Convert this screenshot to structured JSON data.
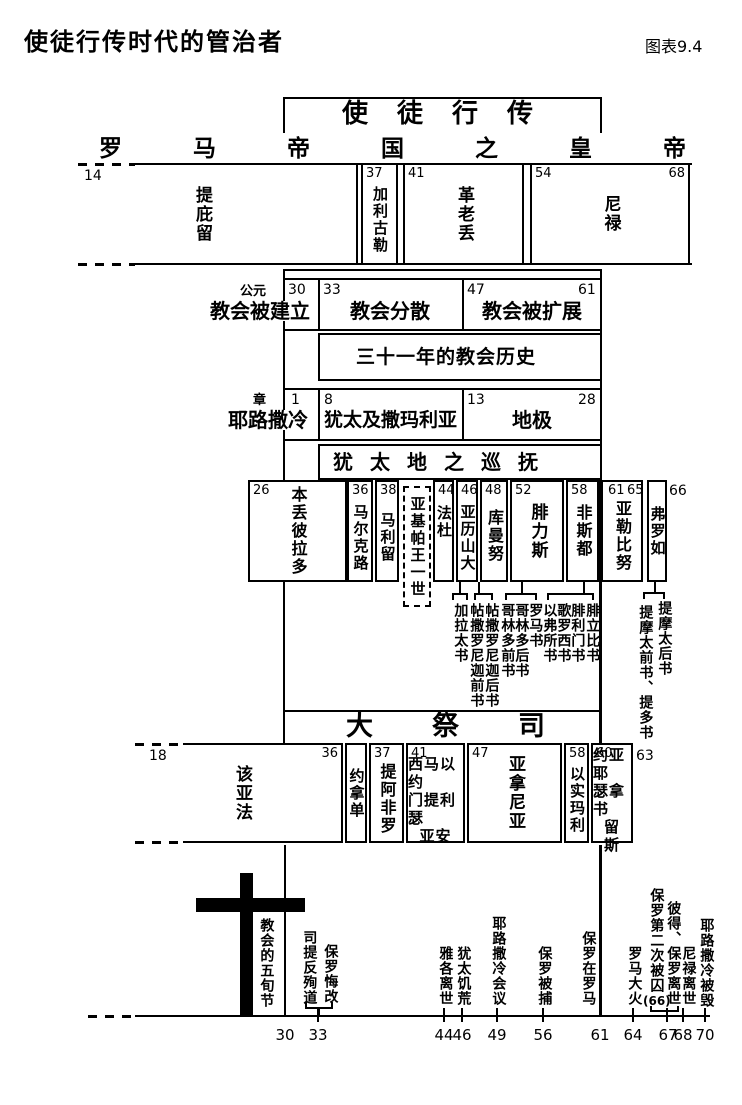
{
  "page": {
    "title": "使徒行传时代的管治者",
    "figure_label": "图表9.4"
  },
  "acts": {
    "label": "使徒行传"
  },
  "emperors": {
    "heading": "罗马帝国之皇帝",
    "year_start": "14",
    "items": [
      {
        "name": "提庇留"
      },
      {
        "name": "加利古勒",
        "year": "37"
      },
      {
        "name": "革老丢",
        "year": "41"
      },
      {
        "name": "尼禄",
        "year": "54",
        "year_end": "68"
      }
    ]
  },
  "church": {
    "era_label": "公元",
    "history_label": "三十一年的教会历史",
    "items": [
      {
        "label": "教会被建立",
        "year": "30"
      },
      {
        "label": "教会分散",
        "year": "33"
      },
      {
        "label": "教会被扩展",
        "year": "47",
        "year_end": "61"
      }
    ]
  },
  "chapters": {
    "era_label": "章",
    "items": [
      {
        "label": "耶路撒冷",
        "num": "1"
      },
      {
        "label": "犹太及撒玛利亚",
        "num": "8"
      },
      {
        "label": "地极",
        "num": "13",
        "num_end": "28"
      }
    ]
  },
  "governors": {
    "heading": "犹太地之巡抚",
    "king": {
      "name": "亚基帕王一世"
    },
    "year_outside": "66",
    "items": [
      {
        "name": "本丢彼拉多",
        "year": "26"
      },
      {
        "name": "马尔克路",
        "year": "36"
      },
      {
        "name": "马利留",
        "year": "38"
      },
      {
        "name": "法杜",
        "year": "44"
      },
      {
        "name": "亚历山大",
        "year": "46"
      },
      {
        "name": "库曼努",
        "year": "48"
      },
      {
        "name": "腓力斯",
        "year": "52"
      },
      {
        "name": "非斯都",
        "year": "58"
      },
      {
        "name": "亚勒比努",
        "year": "61",
        "year2": "65"
      },
      {
        "name": "弗罗如"
      }
    ]
  },
  "epistles": {
    "columns": [
      "加拉太书",
      "帖撒罗尼迦前书",
      "帖撒罗尼迦后书",
      "哥林多前书",
      "哥林多后书",
      "罗马书",
      "以弗所书",
      "歌罗西书",
      "腓利门书",
      "腓立比书"
    ],
    "pastoral": [
      "提摩太后书",
      "提摩太前书、提多书"
    ]
  },
  "priests": {
    "heading": "大祭司",
    "year_start": "18",
    "year_outside": "63",
    "items": [
      {
        "name": "该亚法",
        "year_end": "36"
      },
      {
        "name": "约拿单"
      },
      {
        "name": "提阿非罗",
        "year": "37"
      },
      {
        "year": "41",
        "lines": [
          "西马以约",
          "门提利瑟",
          "亚安"
        ]
      },
      {
        "name": "亚拿尼亚",
        "year": "47"
      },
      {
        "name": "以实玛利",
        "year": "58"
      },
      {
        "year": "60",
        "lines": [
          "约亚耶",
          "瑟拿书",
          "留",
          "斯"
        ]
      }
    ]
  },
  "events": {
    "pentecost": "教会的五旬节",
    "stephen": "司提反殉道",
    "paul_conversion": "保罗悔改",
    "items": [
      {
        "label": "雅各离世"
      },
      {
        "label": "犹太饥荒"
      },
      {
        "label": "耶路撒冷会议"
      },
      {
        "label": "保罗被捕"
      },
      {
        "label": "保罗在罗马"
      },
      {
        "label": "罗马大火"
      },
      {
        "label": "保罗第二次被囚",
        "note": "(66)"
      },
      {
        "label": "彼得、保罗离世"
      },
      {
        "label": "尼禄离世"
      },
      {
        "label": "耶路撒冷被毁"
      }
    ]
  },
  "axis": {
    "years": [
      "30",
      "33",
      "44",
      "46",
      "49",
      "56",
      "61",
      "64",
      "67",
      "68",
      "70"
    ]
  },
  "colors": {
    "ink": "#000000",
    "paper": "#ffffff"
  }
}
